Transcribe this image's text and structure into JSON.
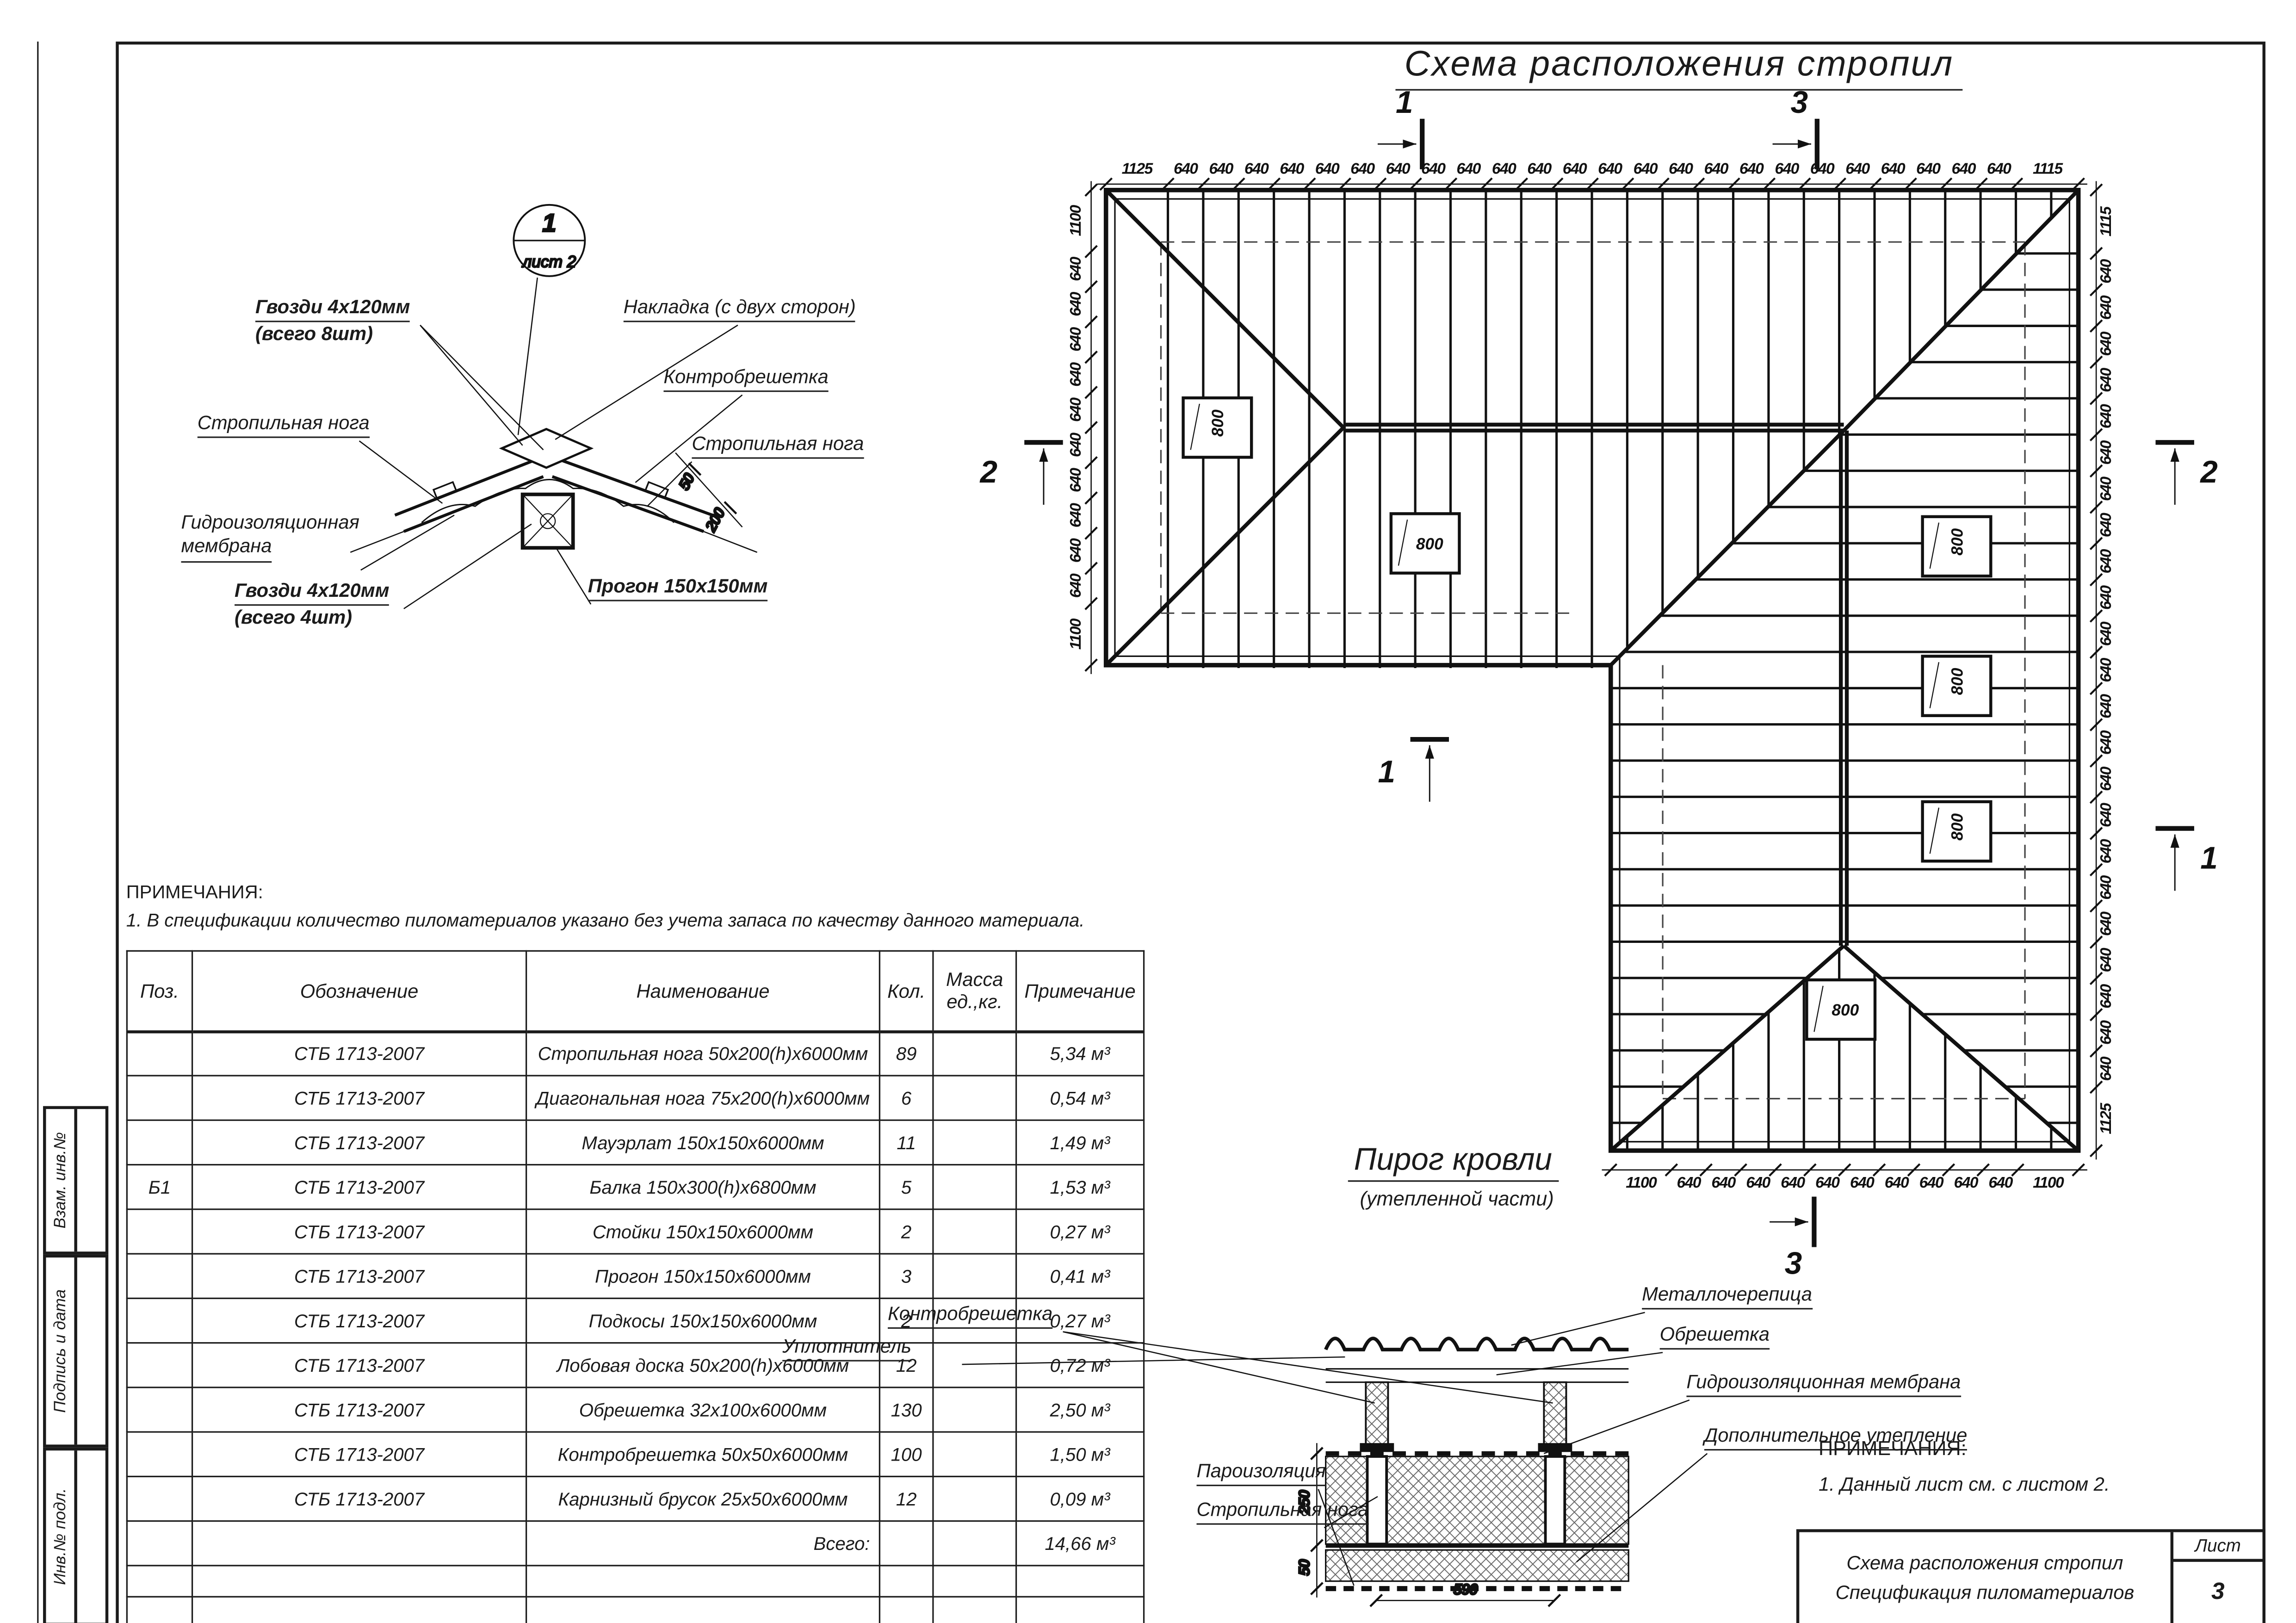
{
  "sheet_title": "Схема расположения стропил",
  "detail": {
    "marker_number": "1",
    "marker_sheet": "лист 2",
    "labels": {
      "nails_top_1": "Гвозди 4х120мм",
      "nails_top_2": "(всего 8шт)",
      "plate": "Накладка (с двух сторон)",
      "counter_batten": "Контробрешетка",
      "rafter_left": "Стропильная нога",
      "rafter_right": "Стропильная нога",
      "membrane_1": "Гидроизоляционная",
      "membrane_2": "мембрана",
      "nails_bottom_1": "Гвозди 4х120мм",
      "nails_bottom_2": "(всего 4шт)",
      "purlin": "Прогон 150х150мм"
    },
    "dims": {
      "d50": "50",
      "d200": "200"
    }
  },
  "plan": {
    "dims": {
      "top": {
        "first": "1125",
        "mid": "640",
        "mid_count": 24,
        "last": "1115"
      },
      "left": {
        "first": "1100",
        "mid": "640",
        "mid_count": 10,
        "last": "1100"
      },
      "right": {
        "first": "1115",
        "mid": "640",
        "mid_count": 23,
        "last": "1125"
      },
      "bottom": {
        "first": "1100",
        "mid": "640",
        "mid_count": 10,
        "last": "1100"
      }
    },
    "openings": [
      "800",
      "800",
      "800",
      "800",
      "800",
      "800"
    ],
    "section_markers": {
      "top_left": "1",
      "top_right": "3",
      "left": "2",
      "right": "2",
      "mid_left": "1",
      "mid_right": "1",
      "bottom": "3"
    }
  },
  "notes_left": {
    "heading": "ПРИМЕЧАНИЯ:",
    "item": "1. В спецификации количество пиломатериалов указано без учета запаса по качеству данного материала."
  },
  "spec": {
    "headers": [
      "Поз.",
      "Обозначение",
      "Наименование",
      "Кол.",
      "Масса ед.,кг.",
      "Примечание"
    ],
    "rows": [
      {
        "pos": "",
        "sign": "СТБ 1713-2007",
        "name": "Стропильная нога 50х200(h)х6000мм",
        "qty": "89",
        "mass": "",
        "note": "5,34 м³"
      },
      {
        "pos": "",
        "sign": "СТБ 1713-2007",
        "name": "Диагональная нога 75х200(h)х6000мм",
        "qty": "6",
        "mass": "",
        "note": "0,54 м³"
      },
      {
        "pos": "",
        "sign": "СТБ 1713-2007",
        "name": "Мауэрлат 150х150х6000мм",
        "qty": "11",
        "mass": "",
        "note": "1,49 м³"
      },
      {
        "pos": "Б1",
        "sign": "СТБ 1713-2007",
        "name": "Балка 150х300(h)х6800мм",
        "qty": "5",
        "mass": "",
        "note": "1,53 м³"
      },
      {
        "pos": "",
        "sign": "СТБ 1713-2007",
        "name": "Стойки 150х150х6000мм",
        "qty": "2",
        "mass": "",
        "note": "0,27 м³"
      },
      {
        "pos": "",
        "sign": "СТБ 1713-2007",
        "name": "Прогон 150х150х6000мм",
        "qty": "3",
        "mass": "",
        "note": "0,41 м³"
      },
      {
        "pos": "",
        "sign": "СТБ 1713-2007",
        "name": "Подкосы 150х150х6000мм",
        "qty": "2",
        "mass": "",
        "note": "0,27 м³"
      },
      {
        "pos": "",
        "sign": "СТБ 1713-2007",
        "name": "Лобовая доска 50х200(h)х6000мм",
        "qty": "12",
        "mass": "",
        "note": "0,72 м³"
      },
      {
        "pos": "",
        "sign": "СТБ 1713-2007",
        "name": "Обрешетка 32х100х6000мм",
        "qty": "130",
        "mass": "",
        "note": "2,50 м³"
      },
      {
        "pos": "",
        "sign": "СТБ 1713-2007",
        "name": "Контробрешетка 50х50х6000мм",
        "qty": "100",
        "mass": "",
        "note": "1,50 м³"
      },
      {
        "pos": "",
        "sign": "СТБ 1713-2007",
        "name": "Карнизный брусок 25х50х6000мм",
        "qty": "12",
        "mass": "",
        "note": "0,09 м³"
      }
    ],
    "total_label": "Всего:",
    "total_value": "14,66 м³"
  },
  "pie": {
    "heading": "Пирог кровли",
    "subheading": "(утепленной части)",
    "labels": {
      "counter_batten": "Контробрешетка",
      "seal": "Уплотнитель",
      "metal_tile": "Металлочерепица",
      "batten": "Обрешетка",
      "membrane": "Гидроизоляционная мембрана",
      "extra_insulation": "Дополнительное утепление",
      "vapor_barrier": "Пароизоляция",
      "rafter": "Стропильная нога"
    },
    "dims": {
      "d250": "250",
      "d50": "50",
      "d590": "590"
    }
  },
  "notes_right": {
    "heading": "ПРИМЕЧАНИЯ:",
    "item": "1. Данный лист см. с листом 2."
  },
  "titleblock": {
    "line1": "Схема расположения стропил",
    "line2": "Спецификация пиломатериалов",
    "sheet_label": "Лист",
    "sheet_number": "3"
  },
  "stamp": {
    "cell1": "Взам. инв.№",
    "cell2": "Подпись и дата",
    "cell3": "Инв.№ подл."
  }
}
